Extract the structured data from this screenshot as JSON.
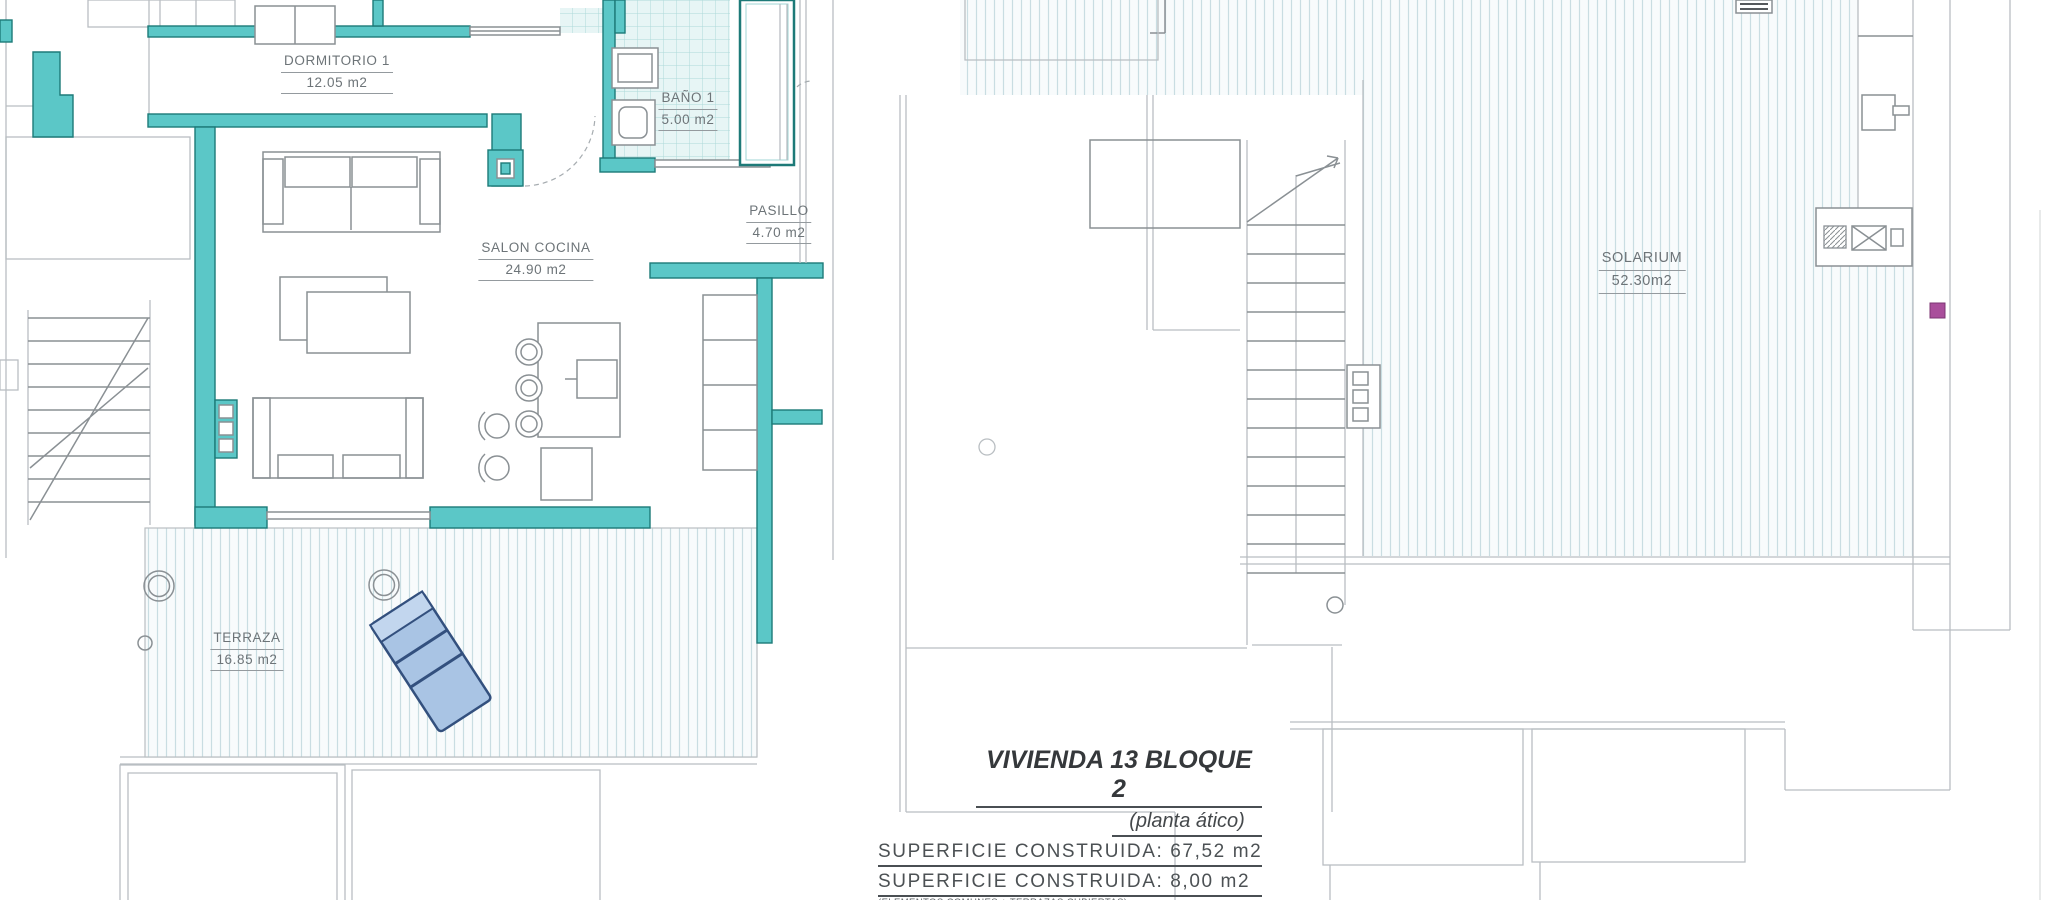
{
  "colors": {
    "wall_teal": "#5bc7c7",
    "wall_teal_dark": "#1d7a78",
    "tile_bg": "#e7f5f5",
    "tile_line": "#aed9d9",
    "deck_bg": "#f8fbfc",
    "deck_line": "#c9dde2",
    "furniture_gray": "#8a9094",
    "light_gray": "#b9bec2",
    "lounger_blue": "#a9c4e4",
    "lounger_dark": "#33507e",
    "magenta": "#a94e9b",
    "text_dark": "#44484b",
    "text_label": "#6d7478"
  },
  "plans": {
    "left": {
      "rooms": [
        {
          "id": "dormitorio-1",
          "name": "DORMITORIO 1",
          "area": "12.05 m2"
        },
        {
          "id": "bano-1",
          "name": "BAÑO 1",
          "area": "5.00 m2"
        },
        {
          "id": "pasillo",
          "name": "PASILLO",
          "area": "4.70 m2"
        },
        {
          "id": "salon-cocina",
          "name": "SALON COCINA",
          "area": "24.90 m2"
        },
        {
          "id": "terraza",
          "name": "TERRAZA",
          "area": "16.85 m2"
        }
      ]
    },
    "right": {
      "rooms": [
        {
          "id": "solarium",
          "name": "SOLARIUM",
          "area": "52.30m2"
        }
      ]
    }
  },
  "title_block": {
    "title": "VIVIENDA 13 BLOQUE 2",
    "subtitle": "(planta ático)",
    "superficie_construida_1": "SUPERFICIE CONSTRUIDA: 67,52 m2",
    "superficie_construida_2": "SUPERFICIE CONSTRUIDA: 8,00 m2",
    "superficie_note": "(ELEMENTOS COMUNES + TERRAZAS CUBIERTAS)",
    "terrazas": "TERRAZAS: 69,15 m2"
  }
}
